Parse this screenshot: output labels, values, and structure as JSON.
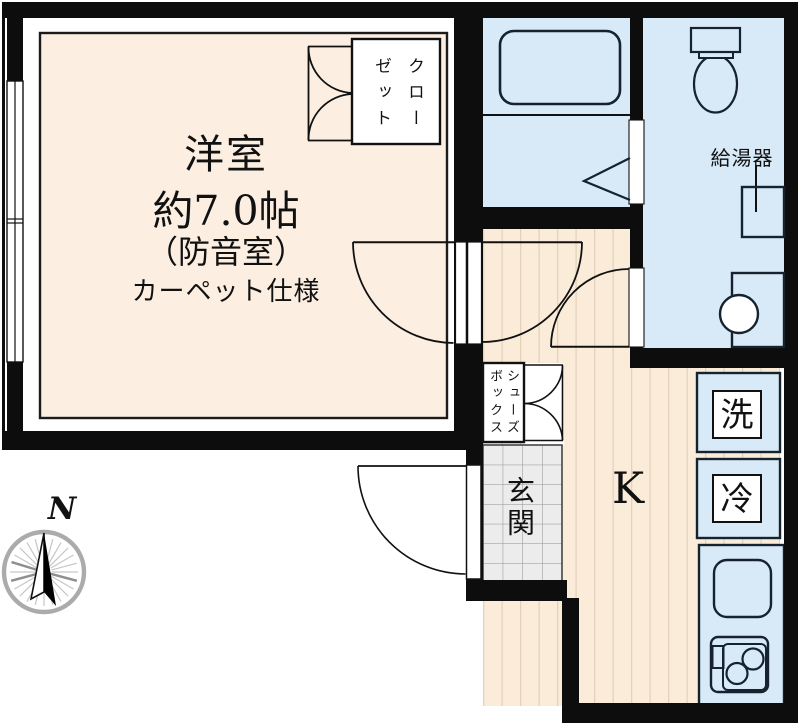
{
  "labels": {
    "main_room": {
      "name": "洋室",
      "size": "約7.0帖",
      "soundproof": "（防音室）",
      "flooring": "カーペット仕様"
    },
    "closet": "クロー\nゼット",
    "shoe_box": "シューズ\nボックス",
    "entrance": "玄関",
    "kitchen": "K",
    "water_heater": "給湯器",
    "washer": "洗",
    "refrigerator": "冷",
    "compass_north": "N"
  },
  "colors": {
    "wall": "#0d0d0d",
    "room_floor": "#fcefe2",
    "wood_floor": "#faecd9",
    "wood_stripe": "#e4d1ba",
    "wet_area_fill": "#d8e9f7",
    "entrance_tile": "#ececec",
    "fixture_outline": "#16232e",
    "compass_ring": "#ababab"
  }
}
